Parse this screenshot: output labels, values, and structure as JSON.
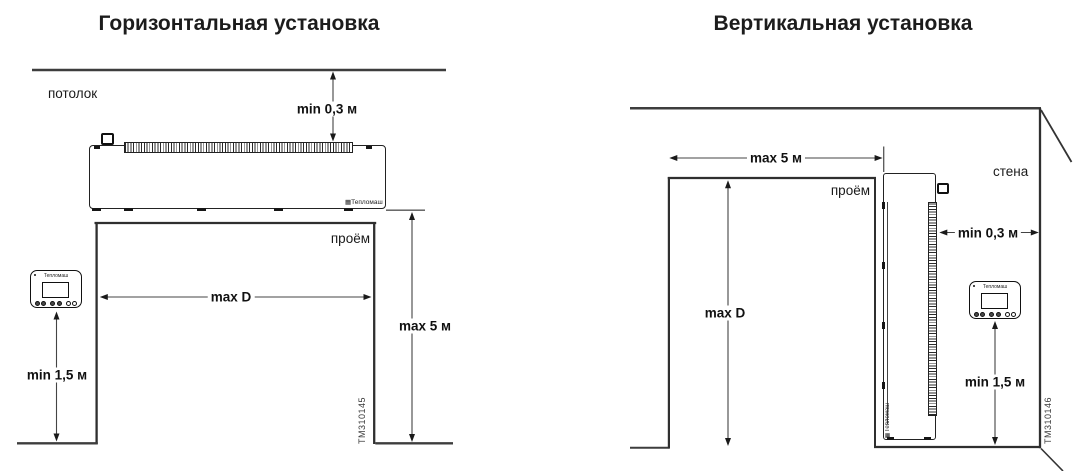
{
  "logo": {
    "icon": "▦",
    "text": "Тепломаш"
  },
  "left": {
    "title": "Горизонтальная установка",
    "ceiling_label": "потолок",
    "opening_label": "проём",
    "dim_ceiling_gap": "min 0,3 м",
    "dim_opening_width": "max D",
    "dim_mount_height": "max 5 м",
    "dim_remote_height": "min 1,5 м",
    "figure_id": "TM310145"
  },
  "right": {
    "title": "Вертикальная установка",
    "wall_label": "стена",
    "opening_label": "проём",
    "dim_opening_width": "max 5 м",
    "dim_opening_height": "max D",
    "dim_wall_gap": "min 0,3 м",
    "dim_remote_height": "min 1,5 м",
    "figure_id": "TM310146"
  }
}
